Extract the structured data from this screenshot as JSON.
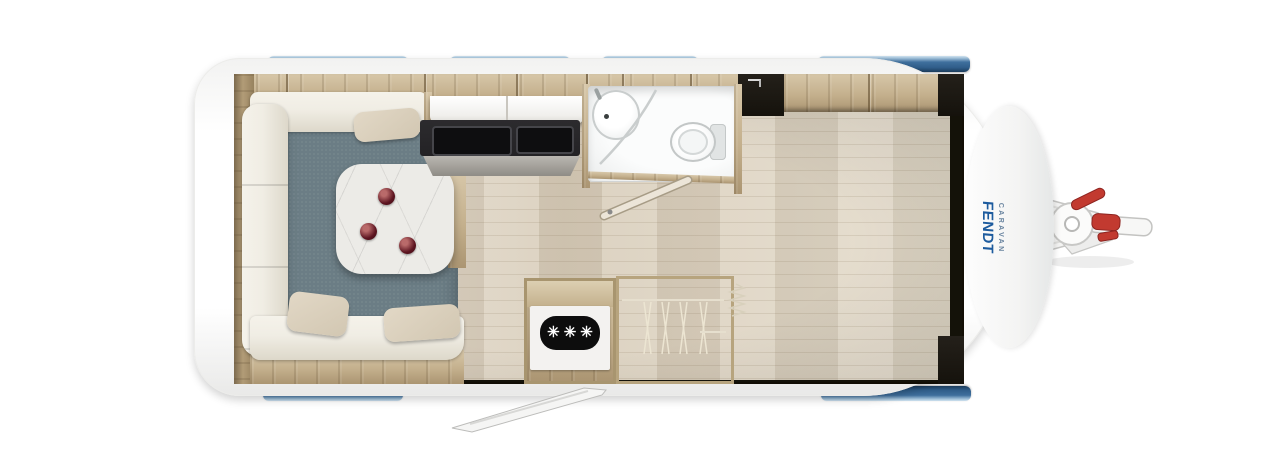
{
  "brand": {
    "name": "FENDT",
    "subtitle": "CARAVAN"
  },
  "fridge": {
    "freezer_symbol": "✳✳✳"
  },
  "icons": {
    "freezer_rating": "three-star freezer symbol",
    "locker_latch": "overhead locker latch"
  },
  "colors": {
    "window_blue": "#3f6f9d",
    "window_blue_dark": "#1c3c5c",
    "window_highlight": "#cfe2ef",
    "logo_blue": "#1d5b9e",
    "logo_gray_blue": "#6a85a0",
    "accent_red": "#c23a30",
    "accent_red_dark": "#8e2420",
    "carpet_gray": "#6b7d85",
    "counter_dark": "#232225",
    "wood_light": "#d7c7a9",
    "wood_mid": "#c4b08d",
    "floor_light": "#e4dccd",
    "sofa_cream": "#f0ede4",
    "bedding_white": "#ecebe9",
    "headboard_gray": "#8e9296",
    "watermark_gold": "#d0a23b",
    "watermark_green": "#15683f"
  }
}
